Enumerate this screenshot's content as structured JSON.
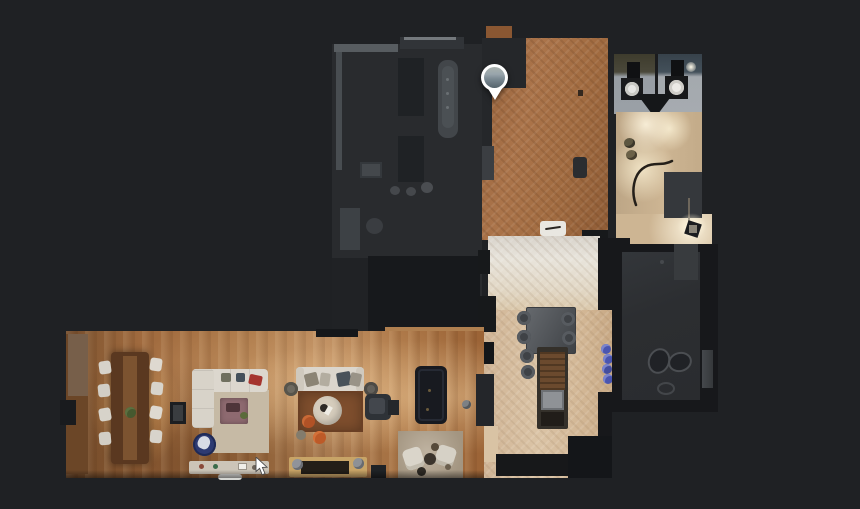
{
  "app": {
    "description": "3D-tour viewer in top-down floor-plan mode on a dark canvas",
    "background_color": "#1f2124",
    "visible_text": "none"
  },
  "marker": {
    "name": "panorama-location-pin",
    "shape": "white teardrop pin containing a circular panorama thumbnail",
    "position": {
      "x": 495,
      "y": 80
    },
    "ring_color": "#ffffff",
    "thumbnail_colors": [
      "#aab2ae",
      "#98a4ab",
      "#55636c"
    ]
  },
  "cursor": {
    "name": "mouse-pointer",
    "position": {
      "x": 258,
      "y": 461
    },
    "color": "#ffffff"
  },
  "floorplan": {
    "rooms": [
      {
        "id": "unscanned-rooms-upper-left",
        "floor_color": "#292b2e",
        "notes": "dark unlit rooms with bathtub, fixtures, round stools"
      },
      {
        "id": "entry-hall",
        "floor_color": "#a06a3f",
        "finish": "brown herringbone parquet",
        "notes": "contains white doormat, stool, pin marker"
      },
      {
        "id": "bathroom-left",
        "floor_color": "#989ea4",
        "notes": "toilet with white bowl, dark cistern"
      },
      {
        "id": "bathroom-right",
        "floor_color": "#a4a9ae",
        "notes": "toilet with white bowl, ceiling light"
      },
      {
        "id": "hallway-right",
        "floor_color": "#c9b190",
        "notes": "bright light pools, cable on floor, floor lamp"
      },
      {
        "id": "kitchen",
        "floor_color": "#d6bd9e",
        "finish": "pale herringbone",
        "notes": "island with sink, six round stools, blue bottles"
      },
      {
        "id": "side-room-right",
        "floor_color": "#2c2e31",
        "notes": "dim gray room with faint furniture outlines"
      },
      {
        "id": "living-dining-room",
        "floor_color": "#a8744a",
        "finish": "wide oak planks",
        "furniture": [
          "long dining table with eight white chairs",
          "L-shaped cream sofa",
          "mauve coffee table",
          "blue swivel chair",
          "white console",
          "second cream sofa with pillows",
          "round cream coffee table",
          "orange poufs",
          "brown rug",
          "dark armchair",
          "dark pool table",
          "two white armchairs on beige rug",
          "wooden bench"
        ]
      }
    ],
    "palette": {
      "background": "#1f2124",
      "dark_room": "#292b2e",
      "near_black": "#17191c",
      "parquet_brown": "#a06a3f",
      "oak_floor": "#a8744a",
      "pale_floor": "#e3ddd2",
      "beige_floor": "#d6bd9e",
      "tile_gray": "#9aa0a6",
      "accent_blue": "#4a55b0",
      "accent_orange": "#b15226",
      "accent_red": "#a5342e",
      "sofa_cream": "#dcd7ce"
    }
  }
}
